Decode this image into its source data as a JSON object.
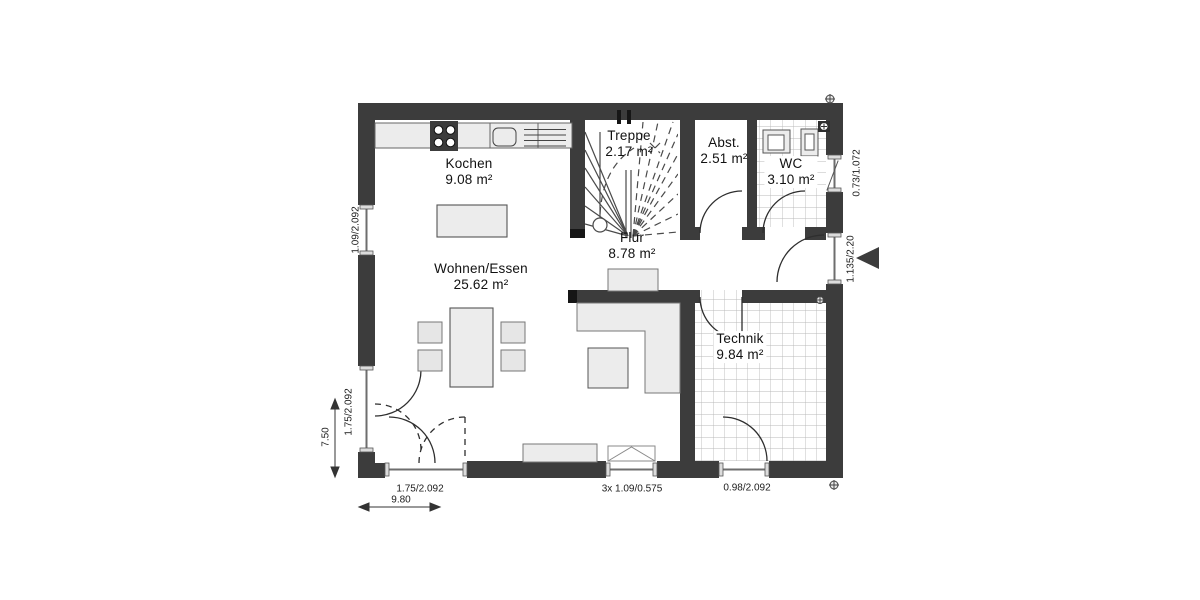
{
  "rooms": [
    {
      "name": "Kochen",
      "area": "9.08 m²"
    },
    {
      "name": "Wohnen/Essen",
      "area": "25.62 m²"
    },
    {
      "name": "Treppe",
      "area": "2.17 m²"
    },
    {
      "name": "Flur",
      "area": "8.78 m²"
    },
    {
      "name": "Abst.",
      "area": "2.51 m²"
    },
    {
      "name": "WC",
      "area": "3.10 m²"
    },
    {
      "name": "Technik",
      "area": "9.84 m²"
    }
  ],
  "dimensions": {
    "left_window": "1.09/2.092",
    "left_door": "1.75/2.092",
    "left_total": "7.50",
    "bottom_door": "1.75/2.092",
    "bottom_window": "3x 1.09/0.575",
    "bottom_technik_door": "0.98/2.092",
    "bottom_total": "9.80",
    "wc_window": "0.73/1.072",
    "entrance_door": "1.135/2.20"
  },
  "colors": {
    "wall": "#3c3c3c",
    "furniture_fill": "#ececec",
    "tile_line": "#b9b9b9"
  }
}
